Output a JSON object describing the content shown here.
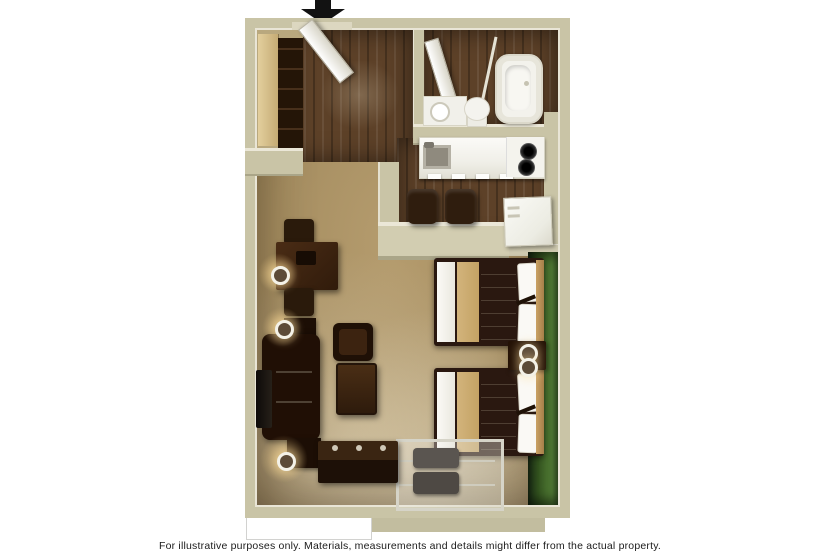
{
  "caption": {
    "text": "For illustrative purposes only.  Materials, measurements and details might differ from the actual property."
  },
  "plan": {
    "title": "Extended-stay studio suite floor plan (top-down 3D render)",
    "entrance": {
      "arrow_direction": "down",
      "points_at": "entry door"
    },
    "rooms": [
      {
        "name": "entry",
        "floor": "dark wood",
        "features": [
          "entry-door",
          "closet",
          "wardrobe"
        ]
      },
      {
        "name": "bathroom",
        "floor": "dark wood",
        "features": [
          "bathtub",
          "shower-curtain-rod",
          "vanity-sink",
          "toilet",
          "bathroom-door"
        ]
      },
      {
        "name": "kitchen",
        "floor": "dark wood",
        "features": [
          "counter",
          "kitchen-sink",
          "two-burner-cooktop",
          "refrigerator",
          "bar-stool",
          "bar-stool",
          "half-wall"
        ]
      },
      {
        "name": "living-sleeping-area",
        "floor": "carpet",
        "features": [
          "double-bed",
          "double-bed",
          "nightstand-with-two-lamps",
          "luggage-rack-with-bags",
          "media-console",
          "sofa",
          "tv",
          "armchair",
          "ottoman",
          "dining-table",
          "dining-chair",
          "dining-chair",
          "end-table",
          "end-table",
          "lamp",
          "lamp",
          "lamp"
        ]
      }
    ],
    "accent_wall": {
      "location": "behind bed headboards, right side",
      "color": "#47702f"
    },
    "colors": {
      "background": "#ffffff",
      "wall_tan": "#c9c4a6",
      "wall_highlight": "#e9e5d6",
      "carpet": "#ab9368",
      "wood_floor": "#5d4128",
      "accent_green": "#47702f",
      "fixture_white": "#f4f3ee",
      "furniture_brown": "#2e1a0c",
      "arrow_black": "#121212"
    }
  }
}
